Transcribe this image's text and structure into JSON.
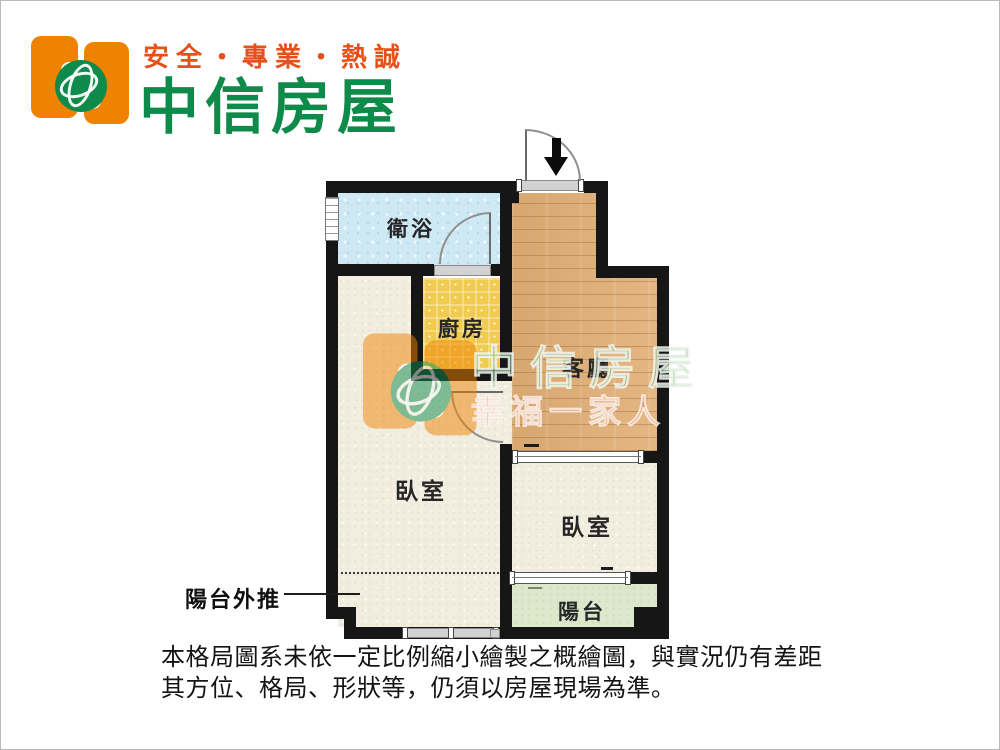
{
  "header": {
    "slogan": "安全・專業・熱誠",
    "brand_name": "中信房屋"
  },
  "floorplan": {
    "rooms": {
      "bathroom": "衛浴",
      "kitchen": "廚房",
      "living": "客廳",
      "bedroom_left": "臥室",
      "bedroom_right": "臥室",
      "balcony": "陽台"
    },
    "annotation_label": "陽台外推"
  },
  "watermark": {
    "brand": "中信房屋",
    "tagline": "幸福一家人"
  },
  "disclaimer": {
    "line1": "本格局圖系未依一定比例縮小繪製之概繪圖，與實況仍有差距",
    "line2": "其方位、格局、形狀等，仍須以房屋現場為準。"
  },
  "colors": {
    "brand_orange": "#EF8200",
    "brand_green": "#0E8A4A",
    "slogan_red": "#E8501A",
    "wall": "#161616",
    "bathroom": "#CFE9F4",
    "kitchen": "#F0CB4F",
    "living_wood": "#E2B077",
    "bedroom": "#F1EEE0",
    "balcony": "#DCE8CC"
  }
}
